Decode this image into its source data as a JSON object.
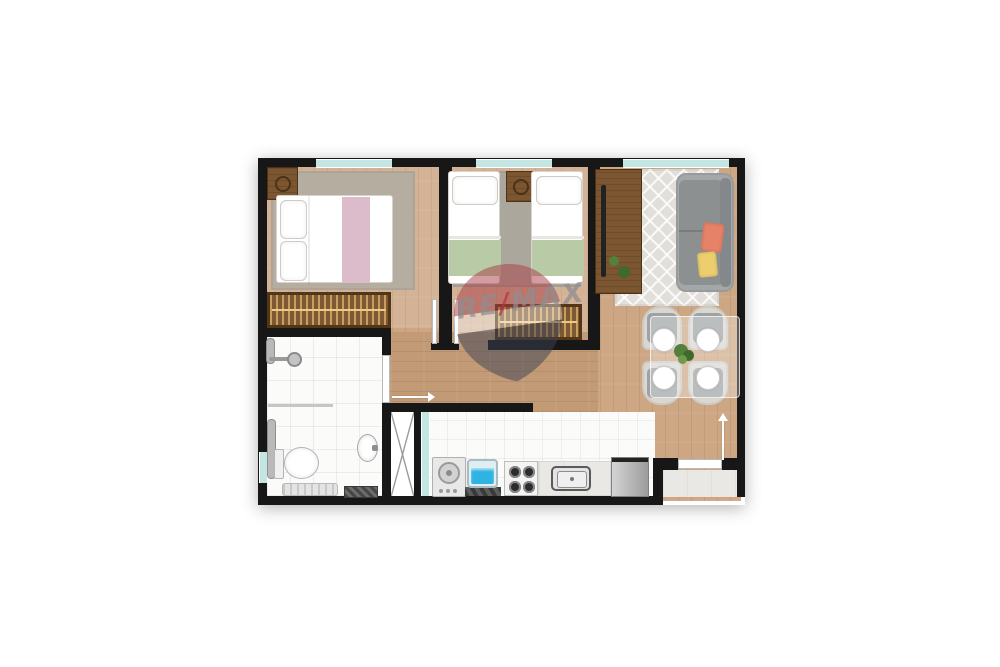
{
  "watermark": {
    "part1": "RE",
    "slash": "/",
    "part2": "MAX"
  },
  "colors": {
    "wall": "#171717",
    "window": "#c3e6e2",
    "wood": "#cda684",
    "wood-hall": "#c29a76",
    "tile": "#fbfbfa",
    "marble": "#eae8e4",
    "rug-bedroom": "#b6ada1",
    "rug-bedroom2": "#aca79d",
    "rug-living": "#e2dfda",
    "furn-wood": "#7c5531",
    "wardrobe": "#7c5833",
    "wardrobe-stripe": "#c89d5e",
    "sofa": "#8d9091",
    "sofa-frame": "#a4a7a8",
    "pillow-coral": "#e58268",
    "pillow-yellow": "#ecce6e",
    "green-blanket": "#b9cba6",
    "pink-throw": "#dcbcca",
    "chair": "#9ea2a3",
    "chair-frame": "#dad7d1",
    "plant": "#55803c",
    "water": "#2fb3e3",
    "steel": "#c2c2c2",
    "balloon-red": "#a83c44",
    "balloon-blue": "#3c4254",
    "watermark-text": "#8e8e92",
    "watermark-slash": "#b5373f"
  }
}
